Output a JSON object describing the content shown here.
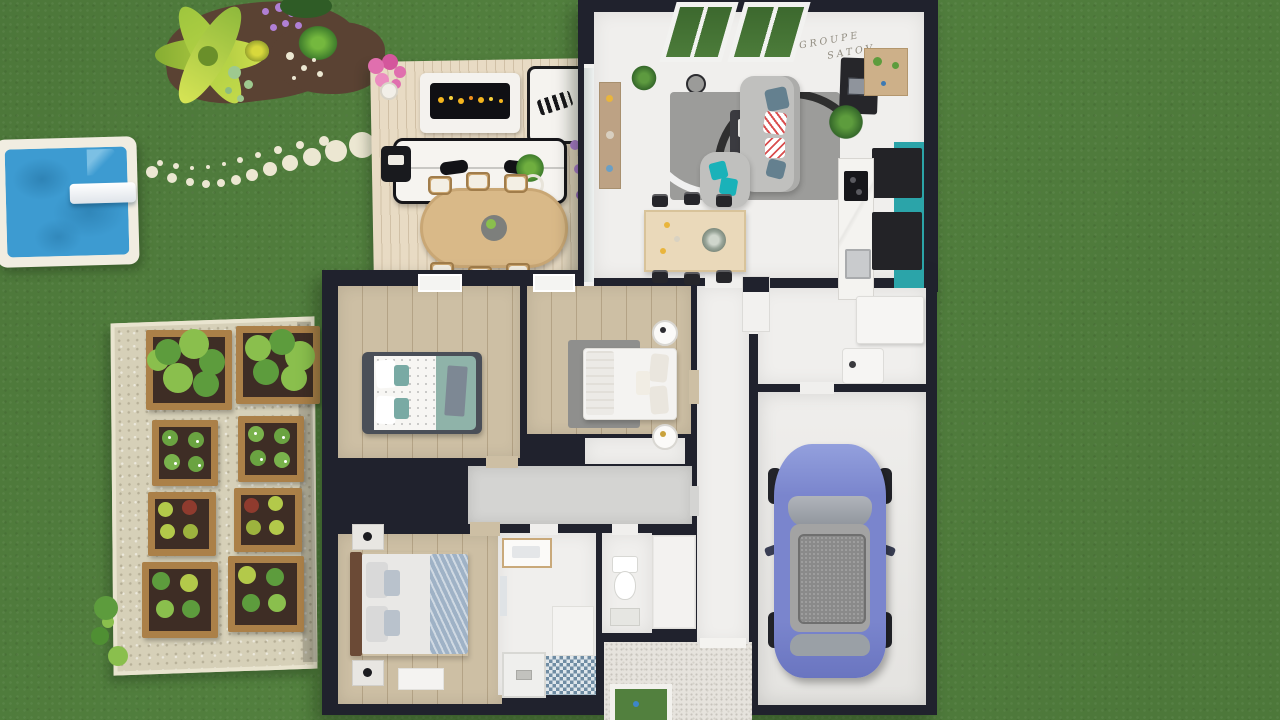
{
  "watermark": {
    "line1": "GROUPE",
    "line2": "SATOV"
  },
  "palette": {
    "grass": "#52803e",
    "wall": "#20222d",
    "floor": "#f0efed",
    "wood": "#cdbfa4",
    "corridor": "#d4d4d2",
    "deck": "#e8dbc4",
    "pool": "#3d9bd1",
    "poolEdge": "#f1ede1",
    "stone": "#ece7d2",
    "pad": "#d6d0b8",
    "planter": "#ab8048",
    "soil": "#3e2d25",
    "mulch": "#5a4233",
    "teal": "#2ba4a9",
    "tealPillow": "#1ab2b9",
    "rug": "#9c9c9a",
    "sofa": "#c0c0be",
    "car": "#7a85cd",
    "carRoof": "#a3a3a3",
    "gravel": "#e6e3dd",
    "marble": "#f2f1ee",
    "furnBlack": "#26262a",
    "furnWood": "#caa56f",
    "tableWood": "#ead9ba",
    "bedTeal": "#8fb3a9",
    "bedSlate": "#9fb2c6",
    "lettuce": "#b3c94a",
    "plant": "#5d9c3d",
    "plantLight": "#8abf4d",
    "pink": "#e06fae",
    "purple": "#b07fd4",
    "flame": "#f5b61e",
    "watermark": "#8f8a7e"
  },
  "scene": {
    "outdoor_items": [
      "lawn",
      "flower-bed",
      "swimming-pool",
      "diving-board",
      "stepping-stones",
      "vegetable-garden",
      "raised-planters",
      "deck-terrace",
      "outdoor-fireplace",
      "outdoor-sofa",
      "outdoor-armchair",
      "outdoor-dining-table",
      "gravel-entry",
      "entry-lawn-inset"
    ],
    "indoor_rooms": [
      "living-room",
      "dining-area",
      "kitchen",
      "hallway",
      "utility-room",
      "bedroom-1",
      "bedroom-2",
      "bedroom-3",
      "dressing-corridor",
      "closet",
      "bathroom",
      "wc",
      "entry",
      "garage"
    ],
    "vehicle": "car-in-garage",
    "planter_count": 8,
    "deck_chair_count": 6,
    "dining_chair_count": 6
  }
}
